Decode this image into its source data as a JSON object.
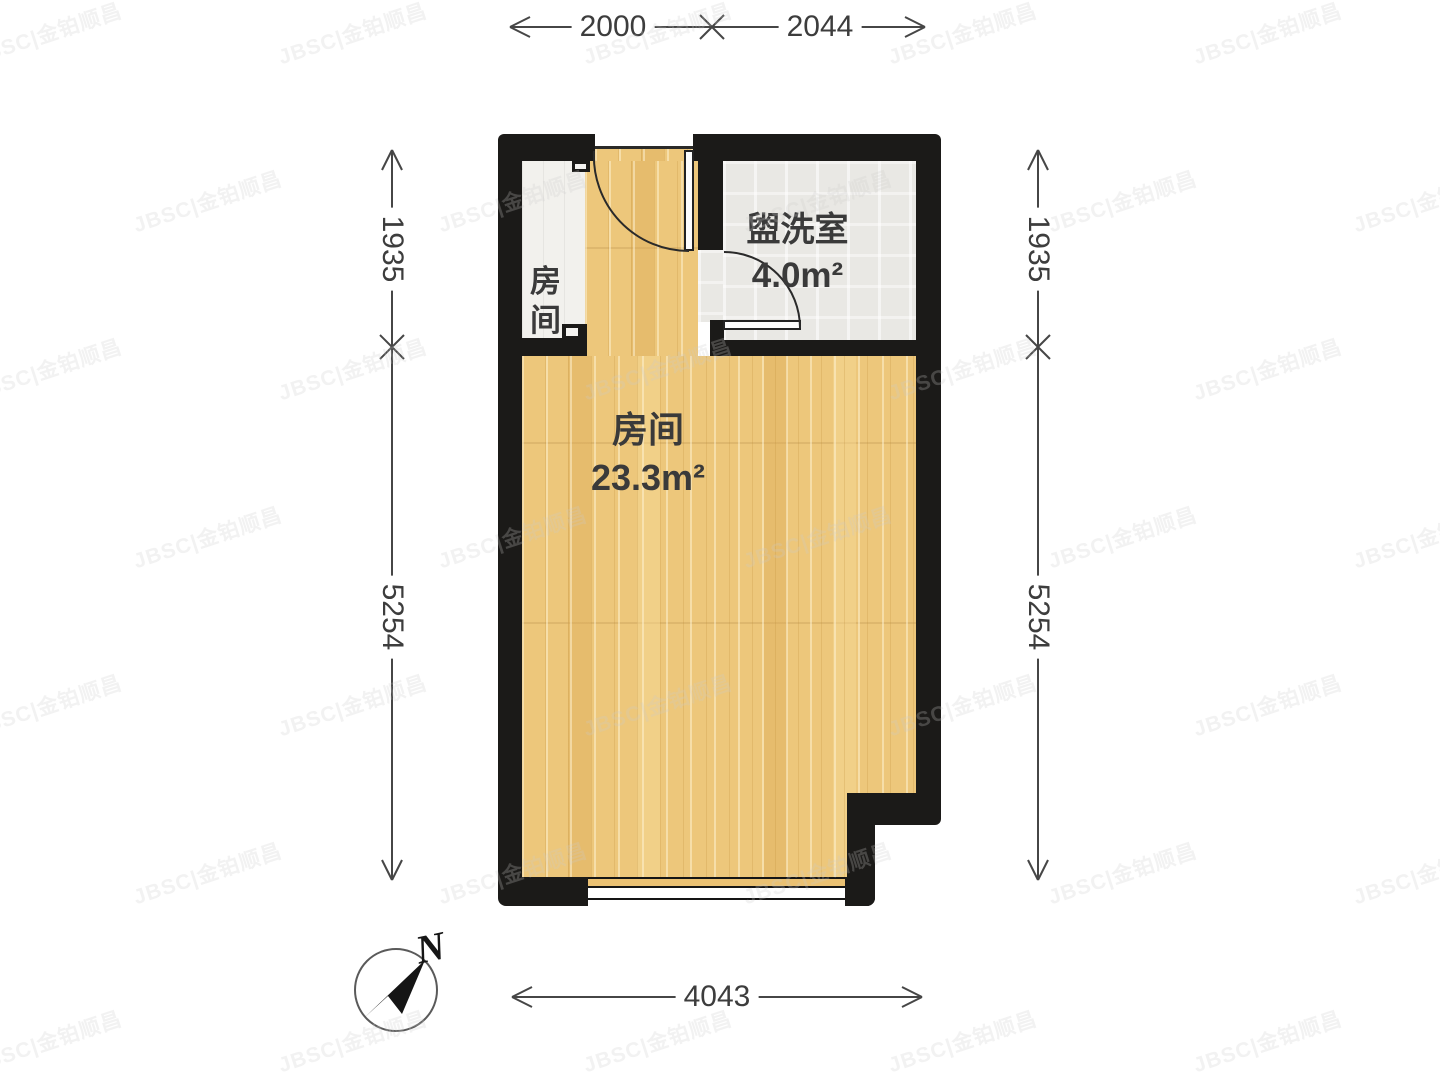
{
  "plan": {
    "rooms": {
      "main": {
        "name": "房间",
        "area": "23.3m²"
      },
      "washroom": {
        "name": "盥洗室",
        "area": "4.0m²"
      },
      "closet": {
        "name": "房间"
      }
    },
    "dims": {
      "top": [
        "2000",
        "2044"
      ],
      "bottom": [
        "4043"
      ],
      "left": [
        "1935",
        "5254"
      ],
      "right": [
        "1935",
        "5254"
      ]
    },
    "compass": {
      "label": "N"
    }
  },
  "watermark": {
    "text": "JBSC|金铂顺昌"
  },
  "colors": {
    "wall": "#1b1a18",
    "wood_floor": "#edc77b",
    "tile_floor": "#e9e8e4",
    "closet_floor": "#f2f1ed",
    "dimension_text": "#3d3d3d",
    "label_text": "#3a3a3a"
  }
}
